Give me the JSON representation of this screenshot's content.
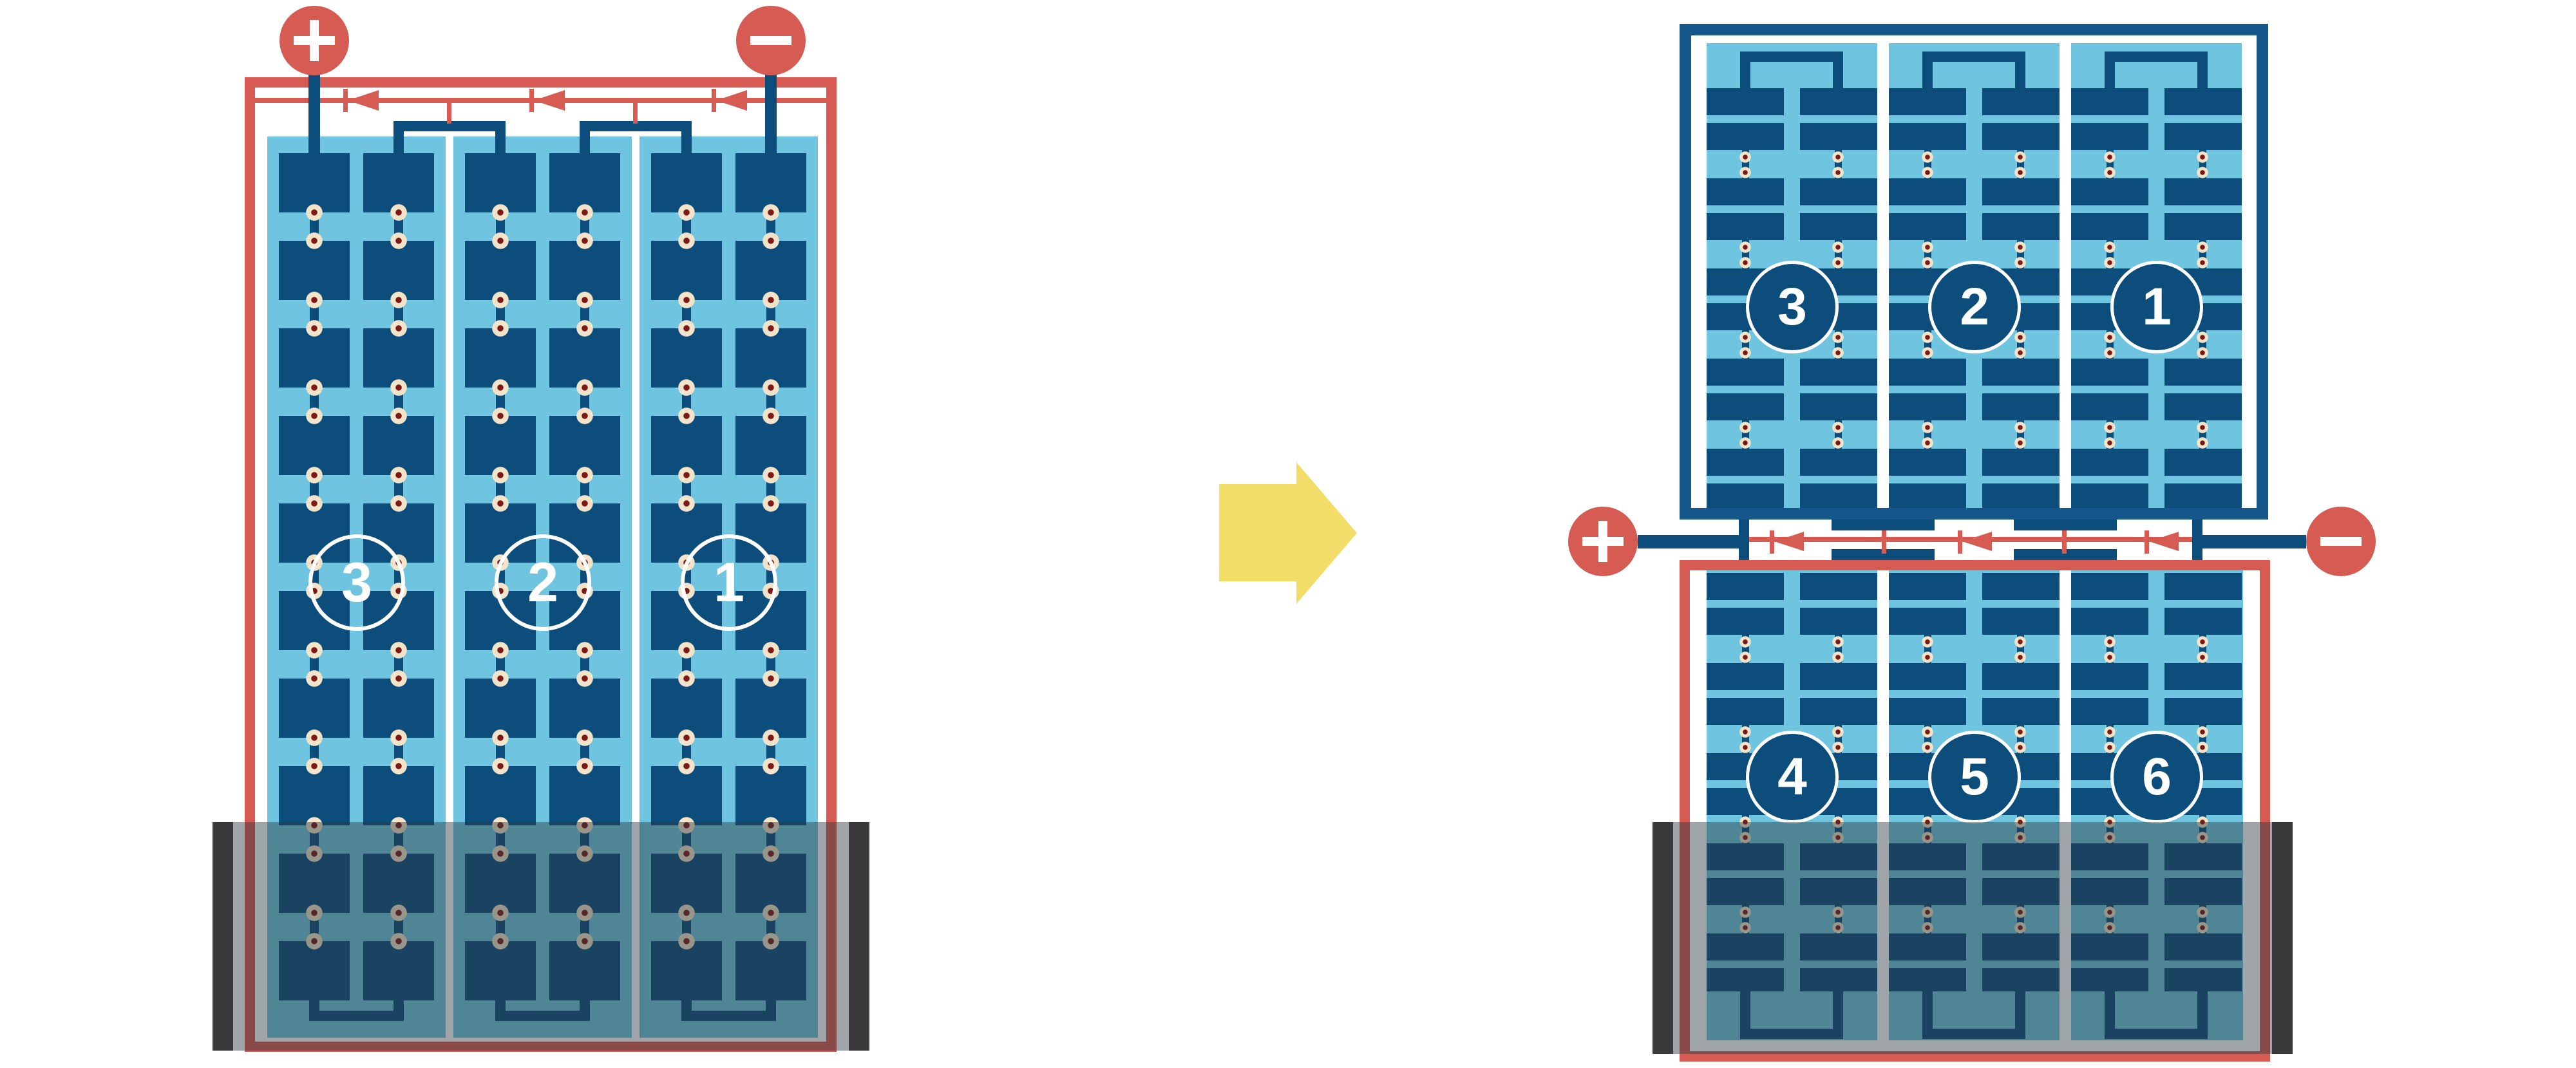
{
  "diagram": {
    "left_module": {
      "positive_symbol": "+",
      "negative_symbol": "-",
      "bypass_diode_count": 3,
      "strings": [
        {
          "label": "3"
        },
        {
          "label": "2"
        },
        {
          "label": "1"
        }
      ]
    },
    "right_module": {
      "positive_symbol": "+",
      "negative_symbol": "-",
      "bypass_diode_count": 3,
      "top_strings": [
        {
          "label": "3"
        },
        {
          "label": "2"
        },
        {
          "label": "1"
        }
      ],
      "bottom_strings": [
        {
          "label": "4"
        },
        {
          "label": "5"
        },
        {
          "label": "6"
        }
      ]
    },
    "colors": {
      "frame_red": "#D55B53",
      "frame_navy": "#15568B",
      "conductor_navy": "#0C4D7C",
      "laminate_blue": "#6FC5DF",
      "solder_dot_cream": "#F2E4CB",
      "solder_dot_core": "#7D1915",
      "divider_white": "#FFFFFF",
      "shade_overlay": "rgba(42,56,62,0.45)",
      "shade_cap_gray": "#3A3A3C",
      "arrow_yellow": "#F1DD67"
    }
  }
}
